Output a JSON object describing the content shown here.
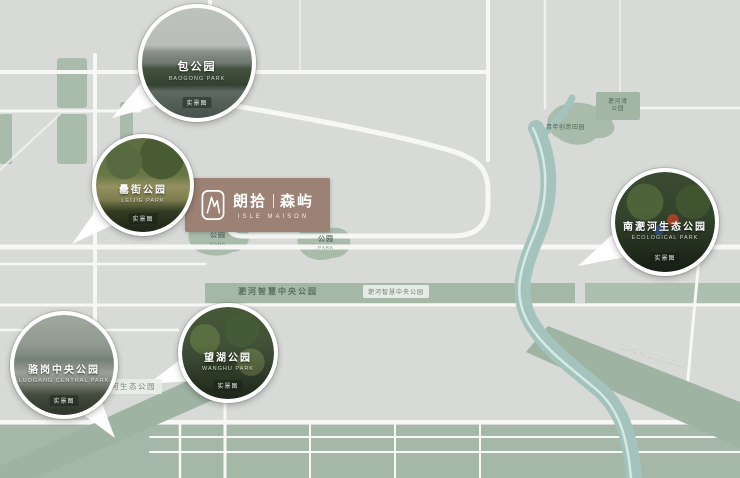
{
  "project": {
    "logo_cn_left": "朗拾",
    "logo_cn_right": "森屿",
    "logo_en": "ISLE MAISON"
  },
  "pois": [
    {
      "id": "baogong-park",
      "title": "包公园",
      "subtitle": "BAOGONG PARK",
      "badge": "实景图"
    },
    {
      "id": "leijie-park",
      "title": "罍街公园",
      "subtitle": "LEIJIE PARK",
      "badge": "实景图"
    },
    {
      "id": "luogang-central-park",
      "title": "骆岗中央公园",
      "subtitle": "LUOGANG CENTRAL PARK",
      "badge": "实景图"
    },
    {
      "id": "wanghu-park",
      "title": "望湖公园",
      "subtitle": "WANGHU PARK",
      "badge": "实景图"
    },
    {
      "id": "nanfeihe-eco-park",
      "title": "南淝河生态公园",
      "subtitle": "ECOLOGICAL PARK",
      "badge": "实景图"
    }
  ],
  "labels": {
    "central_band": "淝河智慧中央公园",
    "central_band_badge": "淝河智慧中央公园",
    "park_patch_1": {
      "title": "公园",
      "sub": "PARK"
    },
    "park_patch_2": {
      "title": "公园",
      "sub": "PARK"
    },
    "top_right_blob": "青年创意田园",
    "top_right_box_line1": "淝河湾",
    "top_right_box_line2": "公园",
    "bottom_left_band": "淝河生态公园",
    "bottom_right_band": "龙栖地湿地公园"
  },
  "colors": {
    "background": "#d8dad7",
    "park_green": "#a9bcab",
    "band_green": "#a5b8a7",
    "river_teal": "#a4c3bd",
    "road_white": "#f7f8f5",
    "logo_brown": "#9c8274"
  }
}
